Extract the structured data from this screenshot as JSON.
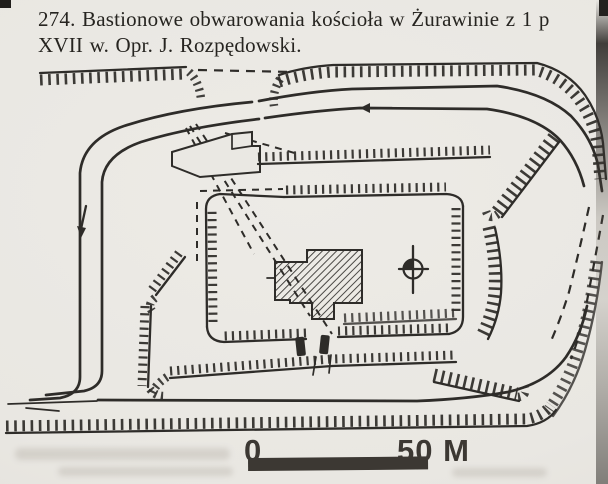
{
  "colors": {
    "paper": "#eae8e3",
    "ink": "#2e2c29",
    "scale-ink": "#3c3833",
    "caption-ink": "#262420"
  },
  "caption": {
    "line1": "274. Bastionowe obwarowania kościoła w Żurawinie z 1 p",
    "line2": "XVII w. Opr. J. Rozpędowski."
  },
  "scale_bar": {
    "zero_label": "0",
    "end_label": "50 M"
  },
  "plan": {
    "type": "fortification-site-plan",
    "features": [
      "outer-ramparts",
      "ring-road",
      "inner-enclosure-wall",
      "church",
      "corner-bastions",
      "gate",
      "north-indicator",
      "scale-bar"
    ]
  }
}
